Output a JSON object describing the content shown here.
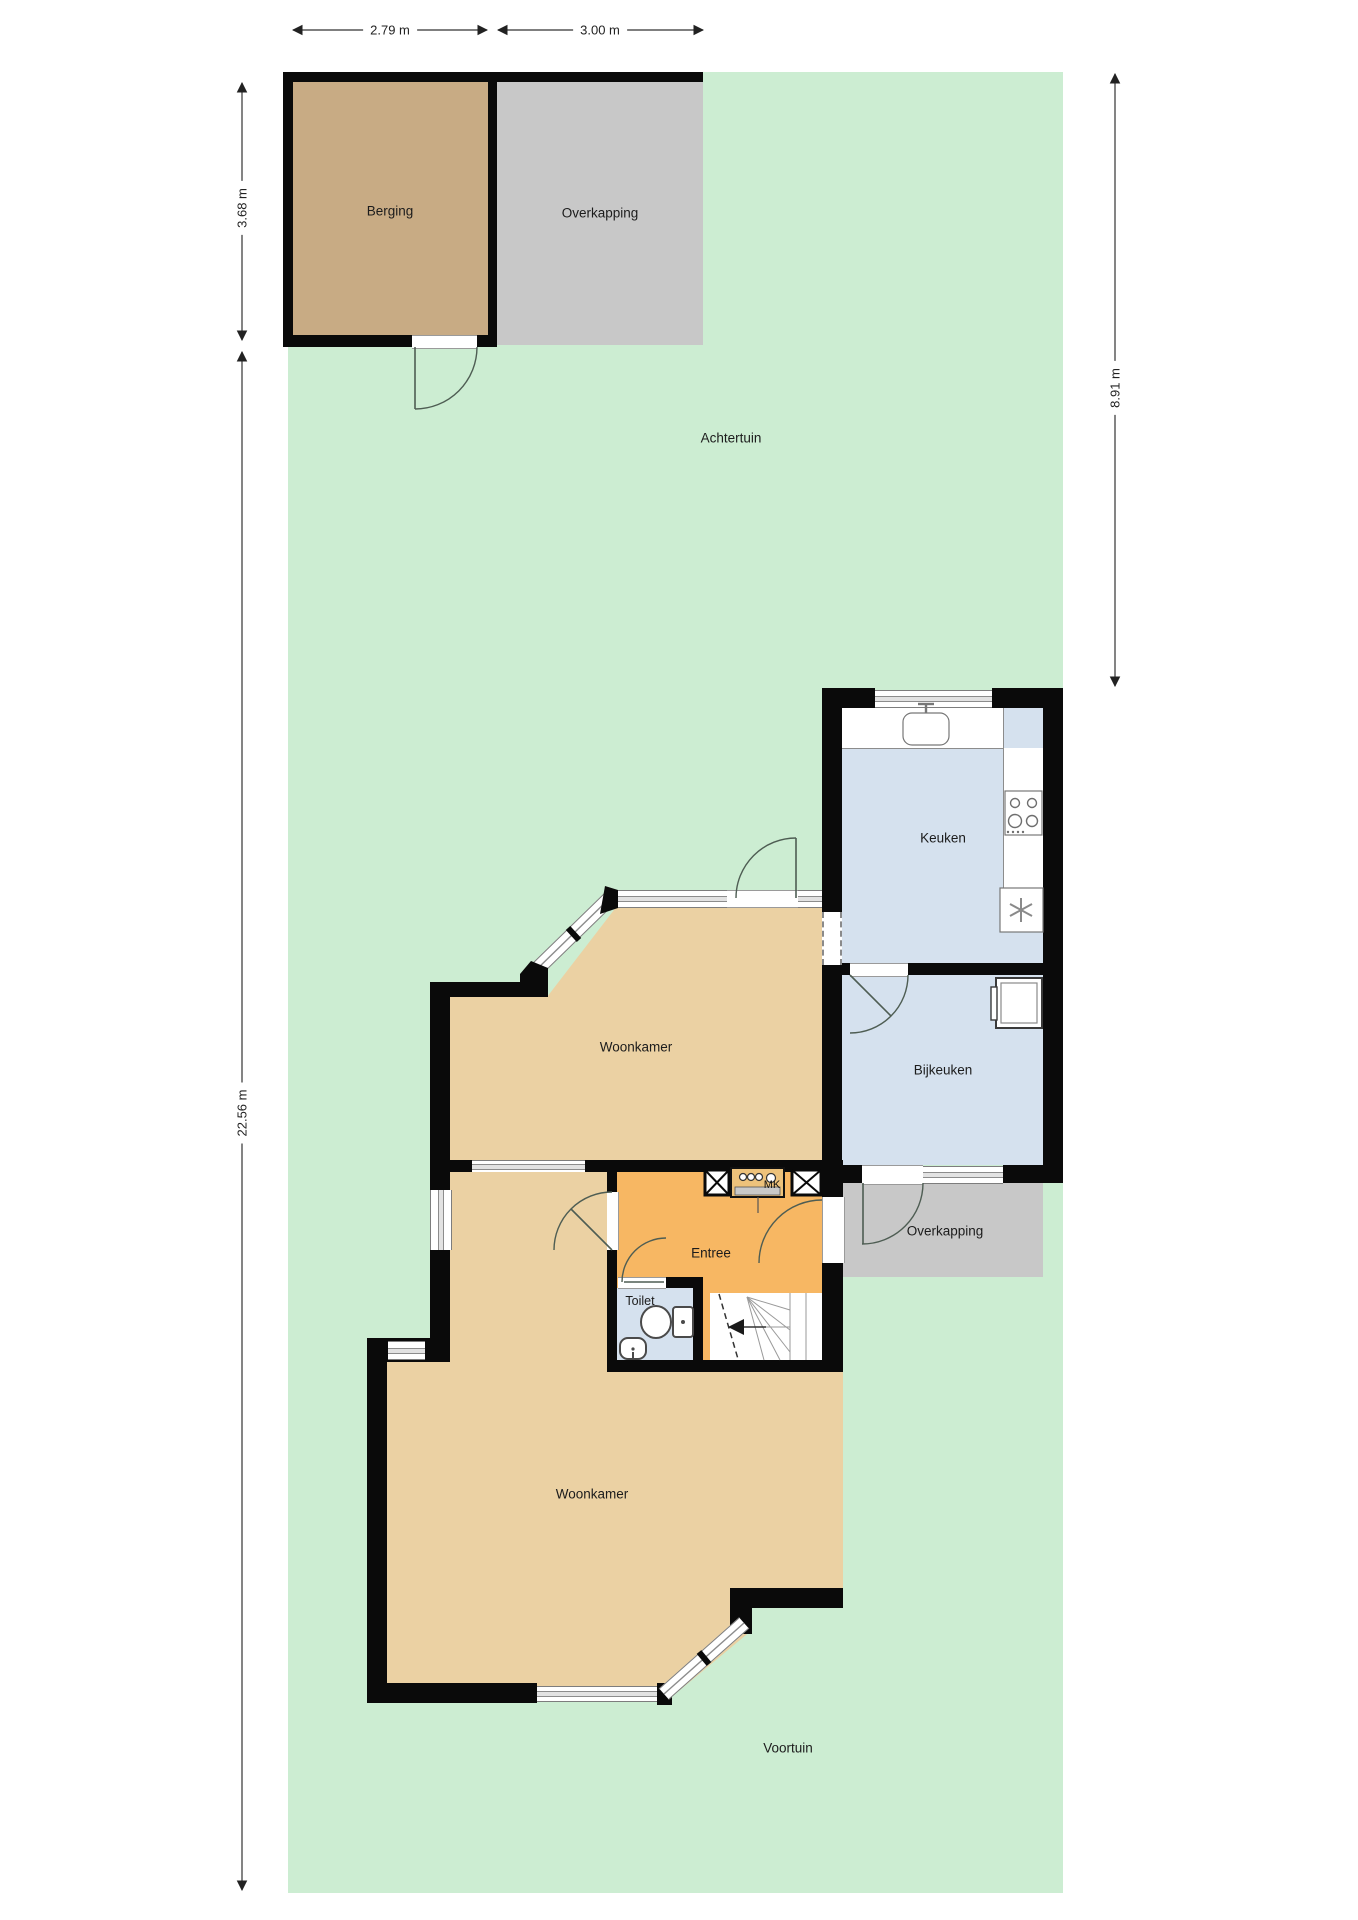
{
  "plan": {
    "rooms": [
      {
        "id": "berging",
        "label": "Berging"
      },
      {
        "id": "overkapping-shed",
        "label": "Overkapping"
      },
      {
        "id": "achtertuin",
        "label": "Achtertuin"
      },
      {
        "id": "keuken",
        "label": "Keuken"
      },
      {
        "id": "woonkamer-upper",
        "label": "Woonkamer"
      },
      {
        "id": "bijkeuken",
        "label": "Bijkeuken"
      },
      {
        "id": "overkapping-lower",
        "label": "Overkapping"
      },
      {
        "id": "entree",
        "label": "Entree"
      },
      {
        "id": "meterkast",
        "label": "MK"
      },
      {
        "id": "toilet",
        "label": "Toilet"
      },
      {
        "id": "woonkamer-lower",
        "label": "Woonkamer"
      },
      {
        "id": "voortuin",
        "label": "Voortuin"
      }
    ],
    "dimensions": {
      "berging_width": "2.79 m",
      "overkapping_width": "3.00 m",
      "berging_depth": "3.68 m",
      "plot_depth": "22.56 m",
      "achtertuin_depth": "8.91 m"
    },
    "colors": {
      "garden": "#ccedd2",
      "wall": "#0a0a0a",
      "berging": "#c8ab84",
      "overkapping": "#c8c8c8",
      "woonkamer": "#ebd1a3",
      "entree": "#f7b763",
      "wet_room": "#d5e1ee"
    }
  }
}
